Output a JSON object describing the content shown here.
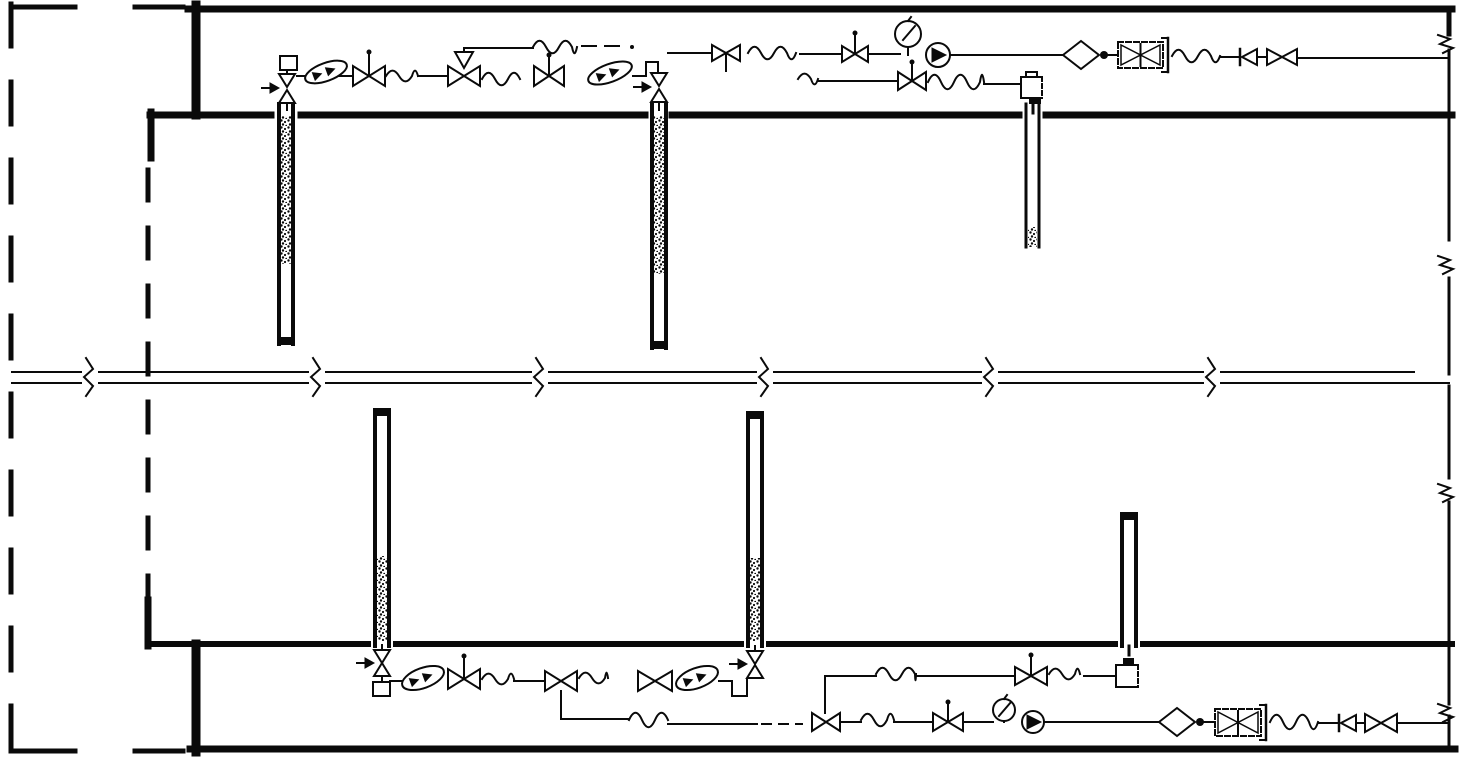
{
  "canvas": {
    "w": 1466,
    "h": 759,
    "bg": "#ffffff",
    "ink": "#0a0a0a",
    "description": "well-and-pipeline-schematic"
  },
  "elements": [
    {
      "type": "hline",
      "name": "top-border",
      "x1": 188,
      "x2": 1452,
      "y": 9,
      "w": 7
    },
    {
      "type": "vline",
      "name": "right-border-top-stub",
      "x": 1449,
      "y1": 9,
      "y2": 34,
      "w": 5
    },
    {
      "type": "segs",
      "name": "top-band-bottom-wall",
      "y": 115,
      "w": 7,
      "segs": [
        [
          150,
          271
        ],
        [
          301,
          645
        ],
        [
          672,
          1019
        ],
        [
          1046,
          1452
        ]
      ]
    },
    {
      "type": "vline",
      "name": "left-wall-stub-top",
      "x": 151,
      "y1": 112,
      "y2": 158,
      "w": 7
    },
    {
      "type": "vline",
      "name": "inner-dashed-line",
      "x": 148,
      "y1": 170,
      "y2": 598,
      "w": 5,
      "dash": "30 28"
    },
    {
      "type": "vline",
      "name": "left-wall-stub-bottom",
      "x": 148,
      "y1": 600,
      "y2": 646,
      "w": 7
    },
    {
      "type": "segs",
      "name": "bottom-band-top-wall",
      "y": 644,
      "w": 6,
      "segs": [
        [
          148,
          368
        ],
        [
          396,
          741
        ],
        [
          769,
          1115
        ],
        [
          1143,
          1452
        ]
      ]
    },
    {
      "type": "vline",
      "name": "left-heavy-bar-top",
      "x": 196,
      "y1": 5,
      "y2": 115,
      "w": 9
    },
    {
      "type": "vline",
      "name": "left-heavy-bar-bottom",
      "x": 196,
      "y1": 644,
      "y2": 752,
      "w": 9
    },
    {
      "type": "hline",
      "name": "bottom-border",
      "x1": 190,
      "x2": 1455,
      "y": 749,
      "w": 7
    },
    {
      "type": "vline",
      "name": "outer-dashed-border-left",
      "x": 11,
      "y1": 4,
      "y2": 754,
      "w": 5,
      "dash": "42 36"
    },
    {
      "type": "hline",
      "name": "outer-dashed-border-top",
      "x1": 11,
      "x2": 183,
      "y": 7,
      "w": 5,
      "dash": "64 60"
    },
    {
      "type": "hline",
      "name": "outer-dashed-border-bottom",
      "x1": 11,
      "x2": 183,
      "y": 751,
      "w": 5,
      "dash": "64 60"
    },
    {
      "type": "hline",
      "name": "mainline-upper-edge",
      "x1": 12,
      "x2": 1414,
      "y": 372,
      "w": 2
    },
    {
      "type": "hline",
      "name": "mainline-lower-edge",
      "x1": 12,
      "x2": 1449,
      "y": 383,
      "w": 2
    },
    {
      "type": "breakv",
      "name": "pipe-break",
      "x": 90
    },
    {
      "type": "breakv",
      "name": "pipe-break",
      "x": 317
    },
    {
      "type": "breakv",
      "name": "pipe-break",
      "x": 540
    },
    {
      "type": "breakv",
      "name": "pipe-break",
      "x": 765
    },
    {
      "type": "breakv",
      "name": "pipe-break",
      "x": 990
    },
    {
      "type": "breakv",
      "name": "pipe-break",
      "x": 1212
    },
    {
      "type": "vsegs",
      "name": "right-border",
      "x": 1449,
      "w": 3,
      "segs": [
        [
          50,
          240
        ],
        [
          278,
          374
        ],
        [
          386,
          478
        ],
        [
          502,
          643
        ],
        [
          648,
          704
        ],
        [
          716,
          749
        ]
      ]
    },
    {
      "type": "breakh",
      "name": "border-break",
      "x": 1449,
      "y": 41
    },
    {
      "type": "breakh",
      "name": "border-break",
      "x": 1449,
      "y": 262
    },
    {
      "type": "breakh",
      "name": "border-break",
      "x": 1449,
      "y": 490
    },
    {
      "type": "breakh",
      "name": "border-break",
      "x": 1449,
      "y": 710
    },
    {
      "type": "well",
      "name": "well-column-1",
      "left": 279,
      "right": 293,
      "y1": 104,
      "y2": 344,
      "wallw": 4,
      "speckle": [
        281,
        116,
        10,
        148
      ],
      "cap": [
        277,
        337,
        18,
        8
      ]
    },
    {
      "type": "well",
      "name": "well-column-2",
      "left": 652,
      "right": 666,
      "y1": 104,
      "y2": 348,
      "wallw": 4,
      "speckle": [
        654,
        116,
        10,
        158
      ],
      "cap": [
        650,
        341,
        18,
        8
      ]
    },
    {
      "type": "well",
      "name": "well-column-3",
      "left": 1026,
      "right": 1039,
      "y1": 104,
      "y2": 247,
      "wallw": 3,
      "speckle": [
        1028,
        227,
        9,
        20
      ]
    },
    {
      "type": "well",
      "name": "well-column-4",
      "left": 375,
      "right": 389,
      "y1": 410,
      "y2": 646,
      "wallw": 4,
      "speckle": [
        377,
        556,
        10,
        85
      ],
      "cap": [
        373,
        408,
        18,
        8
      ]
    },
    {
      "type": "well",
      "name": "well-column-5",
      "left": 748,
      "right": 762,
      "y1": 413,
      "y2": 646,
      "wallw": 4,
      "speckle": [
        750,
        558,
        10,
        83
      ],
      "cap": [
        746,
        411,
        18,
        8
      ]
    },
    {
      "type": "well",
      "name": "well-column-6",
      "left": 1122,
      "right": 1136,
      "y1": 514,
      "y2": 646,
      "wallw": 4,
      "cap": [
        1120,
        512,
        18,
        8
      ]
    },
    {
      "type": "square",
      "name": "well-cap-union",
      "x": 280,
      "y": 56,
      "w": 17,
      "h": 14
    },
    {
      "type": "vbowtie",
      "name": "air-vent-valve",
      "cx": 287,
      "yTop": 74,
      "yBot": 103,
      "topTo": 70,
      "botTo": 110
    },
    {
      "type": "arrow",
      "name": "flow-arrow",
      "x": 279,
      "y": 88
    },
    {
      "type": "hline",
      "name": "pipe",
      "x1": 297,
      "x2": 353,
      "y": 76,
      "w": 2
    },
    {
      "type": "lens",
      "name": "check-valve",
      "cx": 326,
      "cy": 72,
      "rx": 22,
      "ry": 9,
      "rot": -20
    },
    {
      "type": "bowtie",
      "name": "gate-valve",
      "cx": 369,
      "cy": 76,
      "hw": 16,
      "hh": 10,
      "stem": "up",
      "slen": 22,
      "dot": true
    },
    {
      "type": "wave",
      "name": "flex-coupling",
      "x1": 386,
      "x2": 418,
      "y": 76,
      "amp": 6
    },
    {
      "type": "hline",
      "name": "pipe",
      "x1": 418,
      "x2": 448,
      "y": 76,
      "w": 2
    },
    {
      "type": "bowtie",
      "name": "riser-valve",
      "cx": 464,
      "cy": 76,
      "hw": 16,
      "hh": 10,
      "riserTo": 48
    },
    {
      "type": "hline",
      "name": "pipe",
      "x1": 464,
      "x2": 533,
      "y": 48,
      "w": 2
    },
    {
      "type": "wave",
      "name": "flex-coupling",
      "x1": 533,
      "x2": 577,
      "y": 47,
      "amp": 7
    },
    {
      "type": "hline",
      "name": "pipe-dash",
      "x1": 582,
      "x2": 622,
      "y": 46,
      "w": 2,
      "dash": "14 9"
    },
    {
      "type": "dotf",
      "name": "pipe-dot",
      "cx": 632,
      "cy": 47,
      "r": 2
    },
    {
      "type": "hline",
      "name": "pipe",
      "x1": 668,
      "x2": 712,
      "y": 53,
      "w": 2
    },
    {
      "type": "bowtie",
      "name": "gate-valve",
      "cx": 726,
      "cy": 53,
      "hw": 14,
      "hh": 8,
      "stem": "down",
      "slen": 18
    },
    {
      "type": "wave",
      "name": "flex-coupling",
      "x1": 748,
      "x2": 796,
      "y": 53,
      "amp": 7
    },
    {
      "type": "hline",
      "name": "pipe",
      "x1": 800,
      "x2": 842,
      "y": 54,
      "w": 2
    },
    {
      "type": "bowtie",
      "name": "gate-valve",
      "cx": 855,
      "cy": 54,
      "hw": 13,
      "hh": 8,
      "stem": "up",
      "slen": 19,
      "dot": true
    },
    {
      "type": "hline",
      "name": "pipe",
      "x1": 868,
      "x2": 900,
      "y": 54,
      "w": 2
    },
    {
      "type": "gauge",
      "name": "pressure-gauge",
      "cx": 908,
      "cy": 34,
      "r": 13,
      "toY": 55
    },
    {
      "type": "meter",
      "name": "flow-meter",
      "cx": 938,
      "cy": 55,
      "r": 12
    },
    {
      "type": "hline",
      "name": "pipe",
      "x1": 950,
      "x2": 1063,
      "y": 55,
      "w": 2
    },
    {
      "type": "diamond",
      "name": "filter",
      "cx": 1081,
      "cy": 55,
      "hw": 18,
      "hh": 14
    },
    {
      "type": "dotf",
      "name": "junction-dot",
      "cx": 1104,
      "cy": 55,
      "r": 4
    },
    {
      "type": "hline",
      "name": "pipe",
      "x1": 1108,
      "x2": 1118,
      "y": 55,
      "w": 2
    },
    {
      "type": "screen",
      "name": "strainer-cartridge",
      "x": 1118,
      "y": 42,
      "w": 45,
      "h": 26
    },
    {
      "type": "wave",
      "name": "flex-coupling",
      "x1": 1172,
      "x2": 1220,
      "y": 56,
      "amp": 7
    },
    {
      "type": "hline",
      "name": "pipe",
      "x1": 1220,
      "x2": 1238,
      "y": 57,
      "w": 2
    },
    {
      "type": "tricheck",
      "name": "check-valve",
      "x": 1240,
      "cy": 57
    },
    {
      "type": "hline",
      "name": "pipe",
      "x1": 1258,
      "x2": 1267,
      "y": 57,
      "w": 2
    },
    {
      "type": "bowtie",
      "name": "gate-valve",
      "cx": 1282,
      "cy": 57,
      "hw": 15,
      "hh": 8
    },
    {
      "type": "hline",
      "name": "pipe",
      "x1": 1297,
      "x2": 1447,
      "y": 58,
      "w": 2
    },
    {
      "type": "wave",
      "name": "flex-coupling",
      "x1": 482,
      "x2": 520,
      "y": 79,
      "amp": 7
    },
    {
      "type": "bowtie",
      "name": "gate-valve",
      "cx": 549,
      "cy": 76,
      "hw": 15,
      "hh": 10,
      "stem": "up",
      "slen": 19,
      "dot": true
    },
    {
      "type": "lens",
      "name": "check-valve",
      "cx": 610,
      "cy": 73,
      "rx": 23,
      "ry": 9,
      "rot": -20
    },
    {
      "type": "pline",
      "name": "pipe-jog",
      "pts": [
        [
          633,
          76
        ],
        [
          646,
          76
        ],
        [
          646,
          62
        ],
        [
          658,
          62
        ],
        [
          658,
          73
        ]
      ]
    },
    {
      "type": "vbowtie",
      "name": "air-vent-valve",
      "cx": 659,
      "yTop": 73,
      "yBot": 102,
      "botTo": 110
    },
    {
      "type": "arrow",
      "name": "flow-arrow",
      "x": 651,
      "y": 87
    },
    {
      "type": "wave",
      "name": "flex-coupling",
      "x1": 798,
      "x2": 818,
      "y": 79,
      "amp": 6
    },
    {
      "type": "hline",
      "name": "pipe",
      "x1": 818,
      "x2": 898,
      "y": 81,
      "w": 2
    },
    {
      "type": "bowtie",
      "name": "gate-valve",
      "cx": 912,
      "cy": 81,
      "hw": 14,
      "hh": 9,
      "stem": "up",
      "slen": 17,
      "dot": true
    },
    {
      "type": "wave",
      "name": "flex-coupling",
      "x1": 928,
      "x2": 984,
      "y": 82,
      "amp": 8
    },
    {
      "type": "hline",
      "name": "pipe",
      "x1": 984,
      "x2": 1021,
      "y": 84,
      "w": 2
    },
    {
      "type": "capbox",
      "name": "well-seal-box",
      "x": 1021,
      "y": 77,
      "w": 21,
      "h": 21,
      "nubs": [
        {
          "x": 1026,
          "y": 72,
          "w": 11,
          "h": 5,
          "fill": false
        },
        {
          "x": 1029,
          "y": 98,
          "w": 12,
          "h": 6,
          "fill": true
        }
      ],
      "stem": [
        1033,
        104,
        113
      ],
      "stemDash": false
    },
    {
      "type": "vbowtie",
      "name": "air-vent-valve",
      "cx": 382,
      "yTop": 650,
      "yBot": 676,
      "topTo": 645,
      "botTo": 682
    },
    {
      "type": "square",
      "name": "well-cap-union",
      "x": 373,
      "y": 682,
      "w": 17,
      "h": 14
    },
    {
      "type": "arrow",
      "name": "flow-arrow",
      "x": 374,
      "y": 663
    },
    {
      "type": "hline",
      "name": "pipe",
      "x1": 390,
      "x2": 404,
      "y": 681,
      "w": 2
    },
    {
      "type": "lens",
      "name": "check-valve",
      "cx": 423,
      "cy": 678,
      "rx": 22,
      "ry": 10,
      "rot": -20
    },
    {
      "type": "bowtie",
      "name": "gate-valve",
      "cx": 464,
      "cy": 679,
      "hw": 16,
      "hh": 10,
      "stem": "up",
      "slen": 21,
      "dot": true
    },
    {
      "type": "wave",
      "name": "flex-coupling",
      "x1": 482,
      "x2": 514,
      "y": 679,
      "amp": 6
    },
    {
      "type": "hline",
      "name": "pipe",
      "x1": 514,
      "x2": 545,
      "y": 681,
      "w": 2
    },
    {
      "type": "bowtie",
      "name": "gate-valve",
      "cx": 561,
      "cy": 681,
      "hw": 16,
      "hh": 10
    },
    {
      "type": "pline",
      "name": "branch-pipe",
      "pts": [
        [
          561,
          691
        ],
        [
          561,
          719
        ],
        [
          629,
          719
        ]
      ]
    },
    {
      "type": "wave",
      "name": "flex-coupling",
      "x1": 629,
      "x2": 668,
      "y": 720,
      "amp": 8
    },
    {
      "type": "hline",
      "name": "pipe",
      "x1": 668,
      "x2": 757,
      "y": 724,
      "w": 2
    },
    {
      "type": "hline",
      "name": "pipe-dash",
      "x1": 762,
      "x2": 802,
      "y": 724,
      "w": 2,
      "dash": "9 8"
    },
    {
      "type": "wave",
      "name": "flex-coupling",
      "x1": 579,
      "x2": 608,
      "y": 678,
      "amp": 6
    },
    {
      "type": "bowtie",
      "name": "gate-valve",
      "cx": 655,
      "cy": 681,
      "hw": 17,
      "hh": 10
    },
    {
      "type": "lens",
      "name": "check-valve",
      "cx": 697,
      "cy": 678,
      "rx": 22,
      "ry": 10,
      "rot": -20
    },
    {
      "type": "pline",
      "name": "pipe-jog",
      "pts": [
        [
          719,
          681
        ],
        [
          732,
          681
        ],
        [
          732,
          696
        ],
        [
          747,
          696
        ],
        [
          747,
          680
        ]
      ]
    },
    {
      "type": "vbowtie",
      "name": "air-vent-valve",
      "cx": 755,
      "yTop": 651,
      "yBot": 678,
      "topTo": 646
    },
    {
      "type": "arrow",
      "name": "flow-arrow",
      "x": 747,
      "y": 664
    },
    {
      "type": "vline",
      "name": "branch-riser",
      "x": 825,
      "y1": 676,
      "y2": 713,
      "w": 2
    },
    {
      "type": "hline",
      "name": "pipe",
      "x1": 825,
      "x2": 876,
      "y": 676,
      "w": 2
    },
    {
      "type": "wave",
      "name": "flex-coupling",
      "x1": 876,
      "x2": 916,
      "y": 674,
      "amp": 7
    },
    {
      "type": "hline",
      "name": "pipe",
      "x1": 916,
      "x2": 1015,
      "y": 676,
      "w": 2
    },
    {
      "type": "bowtie",
      "name": "gate-valve",
      "cx": 1031,
      "cy": 676,
      "hw": 16,
      "hh": 9,
      "stem": "up",
      "slen": 19,
      "dot": true
    },
    {
      "type": "wave",
      "name": "flex-coupling",
      "x1": 1049,
      "x2": 1080,
      "y": 674,
      "amp": 6
    },
    {
      "type": "hline",
      "name": "pipe",
      "x1": 1084,
      "x2": 1116,
      "y": 676,
      "w": 2
    },
    {
      "type": "capbox",
      "name": "well-seal-box",
      "x": 1116,
      "y": 665,
      "w": 22,
      "h": 22,
      "nubs": [
        {
          "x": 1123,
          "y": 658,
          "w": 11,
          "h": 7,
          "fill": true
        }
      ],
      "stem": [
        1129,
        646,
        658
      ],
      "stemDash": true
    },
    {
      "type": "bowtie",
      "name": "gate-valve",
      "cx": 826,
      "cy": 722,
      "hw": 14,
      "hh": 9
    },
    {
      "type": "hline",
      "name": "pipe",
      "x1": 840,
      "x2": 861,
      "y": 722,
      "w": 2
    },
    {
      "type": "wave",
      "name": "flex-coupling",
      "x1": 861,
      "x2": 894,
      "y": 720,
      "amp": 7
    },
    {
      "type": "hline",
      "name": "pipe",
      "x1": 894,
      "x2": 933,
      "y": 722,
      "w": 2
    },
    {
      "type": "bowtie",
      "name": "gate-valve",
      "cx": 948,
      "cy": 722,
      "hw": 15,
      "hh": 9,
      "stem": "up",
      "slen": 18,
      "dot": true
    },
    {
      "type": "hline",
      "name": "pipe",
      "x1": 963,
      "x2": 993,
      "y": 722,
      "w": 2
    },
    {
      "type": "gauge",
      "name": "pressure-gauge",
      "cx": 1004,
      "cy": 710,
      "r": 11,
      "toY": 722
    },
    {
      "type": "meter",
      "name": "flow-meter",
      "cx": 1033,
      "cy": 722,
      "r": 11
    },
    {
      "type": "hline",
      "name": "pipe",
      "x1": 1044,
      "x2": 1160,
      "y": 722,
      "w": 2
    },
    {
      "type": "diamond",
      "name": "filter",
      "cx": 1177,
      "cy": 722,
      "hw": 18,
      "hh": 14
    },
    {
      "type": "dotf",
      "name": "junction-dot",
      "cx": 1200,
      "cy": 722,
      "r": 4
    },
    {
      "type": "hline",
      "name": "pipe",
      "x1": 1204,
      "x2": 1215,
      "y": 722,
      "w": 2
    },
    {
      "type": "screen",
      "name": "strainer-cartridge",
      "x": 1215,
      "y": 709,
      "w": 46,
      "h": 27
    },
    {
      "type": "wave",
      "name": "flex-coupling",
      "x1": 1270,
      "x2": 1318,
      "y": 722,
      "amp": 8
    },
    {
      "type": "hline",
      "name": "pipe",
      "x1": 1318,
      "x2": 1337,
      "y": 723,
      "w": 2
    },
    {
      "type": "tricheck",
      "name": "check-valve",
      "x": 1339,
      "cy": 723
    },
    {
      "type": "hline",
      "name": "pipe",
      "x1": 1357,
      "x2": 1365,
      "y": 723,
      "w": 2
    },
    {
      "type": "bowtie",
      "name": "gate-valve",
      "cx": 1381,
      "cy": 723,
      "hw": 16,
      "hh": 9
    },
    {
      "type": "hline",
      "name": "pipe",
      "x1": 1397,
      "x2": 1447,
      "y": 723,
      "w": 2
    }
  ]
}
